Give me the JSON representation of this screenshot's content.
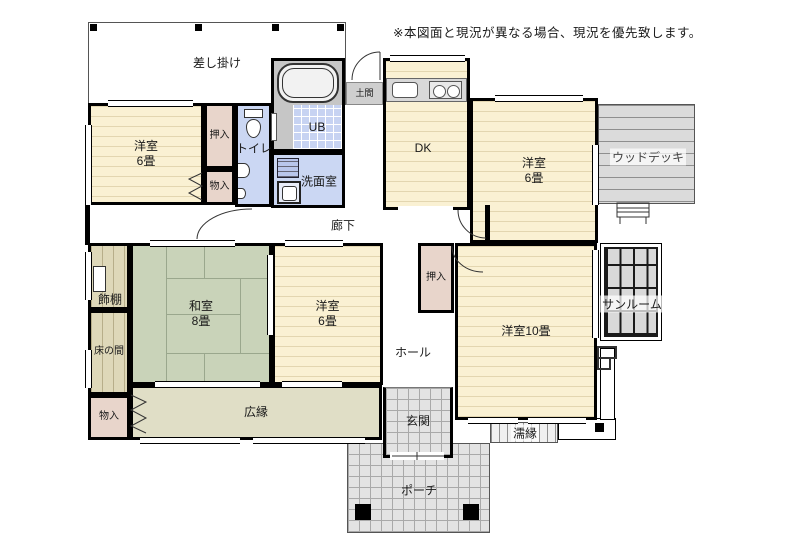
{
  "disclaimer": "※本図面と現況が異なる場合、現況を優先致します。",
  "rooms": {
    "sashikake": {
      "label": "差し掛け"
    },
    "yoshitsu6_left": {
      "label": "洋室\n6畳"
    },
    "oshiire_top": {
      "label": "押入"
    },
    "monoire_top": {
      "label": "物入"
    },
    "toilet": {
      "label": "トイレ"
    },
    "bath": {
      "label": "UB"
    },
    "doma": {
      "label": "土間"
    },
    "senmen": {
      "label": "洗面室"
    },
    "dk": {
      "label": "DK"
    },
    "yoshitsu6_topright": {
      "label": "洋室\n6畳"
    },
    "wooddeck": {
      "label": "ウッドデッキ"
    },
    "rouka": {
      "label": "廊下"
    },
    "kazaridana": {
      "label": "飾棚"
    },
    "tokonoma": {
      "label": "床の間"
    },
    "washitsu": {
      "label": "和室\n8畳"
    },
    "yoshitsu6_mid": {
      "label": "洋室\n6畳"
    },
    "oshiire_mid": {
      "label": "押入"
    },
    "hall": {
      "label": "ホール"
    },
    "yoshitsu10": {
      "label": "洋室10畳"
    },
    "sunroom": {
      "label": "サンルーム"
    },
    "hiroen": {
      "label": "広縁"
    },
    "monoire_bottom": {
      "label": "物入"
    },
    "genkan": {
      "label": "玄関"
    },
    "nureen": {
      "label": "濡縁"
    },
    "porch": {
      "label": "ポーチ"
    }
  },
  "icons": [
    "bathtub-icon",
    "toilet-icon",
    "hand-basin-icon",
    "kitchen-sink-icon",
    "stove-icon",
    "washing-machine-icon",
    "vanity-sink-icon",
    "steps-icon",
    "pillar-icon"
  ],
  "colors": {
    "wall": "#000000",
    "room_cream": "#faf1d3",
    "tatami_green": "#c9d3b9",
    "closet_pink": "#e8d5cb",
    "water_blue": "#cbd7f3",
    "tile_gray": "#d9d9d9",
    "wood_tan": "#ded8b9",
    "veranda_khaki": "#e0dec6"
  }
}
